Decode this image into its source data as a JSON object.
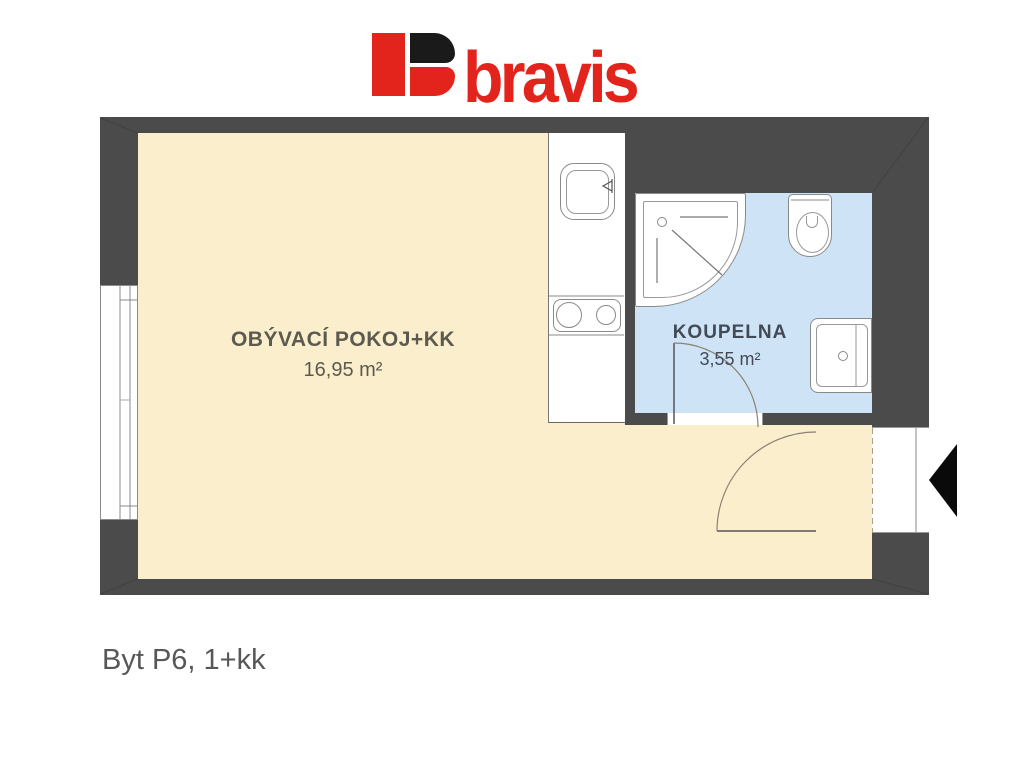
{
  "logo": {
    "text": "bravis",
    "brand_red": "#e2241c",
    "mark": "b-logomark"
  },
  "plan": {
    "rooms": [
      {
        "id": "living",
        "label": "OBÝVACÍ POKOJ+KK",
        "area": "16,95 m²"
      },
      {
        "id": "bathroom",
        "label": "KOUPELNA",
        "area": "3,55 m²"
      }
    ],
    "colors": {
      "wall": "#4b4b4c",
      "living_floor": "#faeecd",
      "bathroom_floor": "#cfe3f6",
      "outline": "#8a8a8a"
    },
    "symbols": [
      "window",
      "entry-door-swing",
      "bathroom-door-swing",
      "entrance-arrow",
      "shower",
      "toilet",
      "washbasin",
      "kitchen-sink",
      "cooktop"
    ]
  },
  "caption": {
    "text": "Byt P6, 1+kk"
  }
}
